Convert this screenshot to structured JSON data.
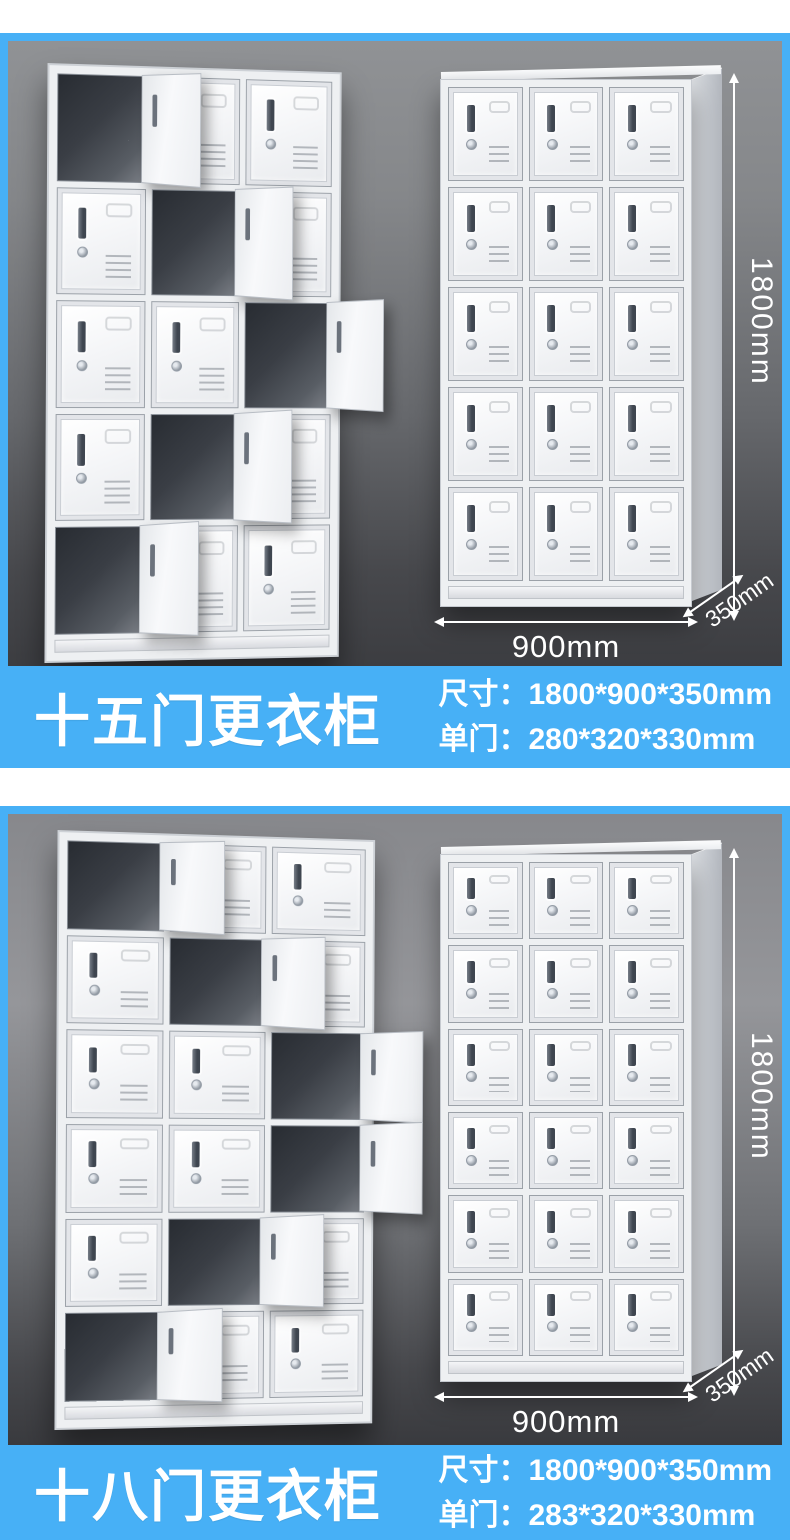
{
  "page": {
    "background": "#ffffff",
    "accent_blue": "#47b0f6",
    "photo_bg_dark": "#3c3d41",
    "photo_bg_light": "#95969a",
    "text_color": "#ffffff"
  },
  "sections": [
    {
      "title": "十五门更衣柜",
      "specs": {
        "size_line": "尺寸：1800*900*350mm",
        "door_line": "单门：280*320*330mm"
      },
      "dims": {
        "height": "1800mm",
        "width": "900mm",
        "depth": "350mm"
      },
      "left_locker": {
        "rows": 5,
        "cols": 3,
        "open": [
          "0-0",
          "1-1",
          "2-2",
          "3-1",
          "4-0"
        ]
      },
      "right_locker": {
        "rows": 5,
        "cols": 3,
        "open": []
      }
    },
    {
      "title": "十八门更衣柜",
      "specs": {
        "size_line": "尺寸：1800*900*350mm",
        "door_line": "单门：283*320*330mm"
      },
      "dims": {
        "height": "1800mm",
        "width": "900mm",
        "depth": "350mm"
      },
      "left_locker": {
        "rows": 6,
        "cols": 3,
        "open": [
          "0-0",
          "1-1",
          "2-2",
          "3-2",
          "4-1",
          "5-0"
        ]
      },
      "right_locker": {
        "rows": 6,
        "cols": 3,
        "open": []
      }
    }
  ]
}
